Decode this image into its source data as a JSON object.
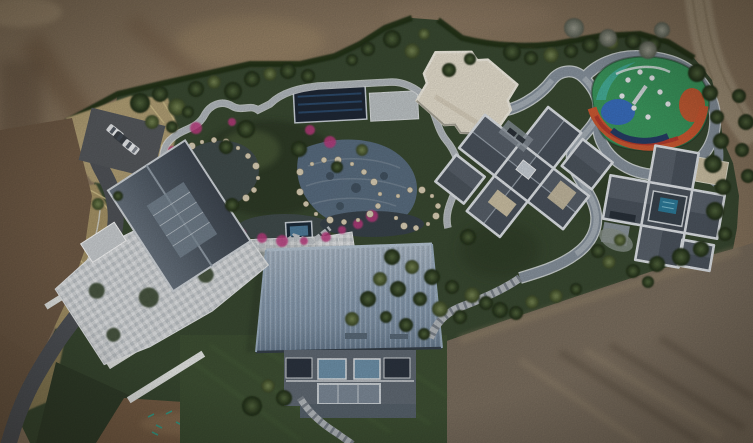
{
  "scene": {
    "type": "aerial-drone-photo",
    "description": "Top-down aerial view of a landscaped private estate surrounded by bare construction dirt: a pond garden with winding stone paths, a large blue metal-roof residence, a checkered-patio house, two gray cross-shaped villas, a cream sports court, a colorful playground, a curving asphalt driveway and a small parking area with cars.",
    "trees": [
      [
        140,
        103,
        10,
        "d"
      ],
      [
        160,
        94,
        8,
        "d"
      ],
      [
        177,
        107,
        9,
        "m"
      ],
      [
        196,
        89,
        8,
        "d"
      ],
      [
        214,
        82,
        7,
        "m"
      ],
      [
        233,
        91,
        9,
        "d"
      ],
      [
        252,
        79,
        8,
        "d"
      ],
      [
        270,
        74,
        7,
        "m"
      ],
      [
        288,
        71,
        8,
        "d"
      ],
      [
        308,
        76,
        7,
        "d"
      ],
      [
        152,
        122,
        7,
        "m"
      ],
      [
        172,
        127,
        6,
        "d"
      ],
      [
        188,
        112,
        6,
        "d"
      ],
      [
        352,
        60,
        6,
        "d"
      ],
      [
        368,
        49,
        7,
        "d"
      ],
      [
        392,
        39,
        9,
        "d"
      ],
      [
        412,
        51,
        8,
        "m"
      ],
      [
        424,
        34,
        6,
        "m"
      ],
      [
        449,
        70,
        7,
        "d"
      ],
      [
        470,
        59,
        6,
        "d"
      ],
      [
        512,
        52,
        9,
        "d"
      ],
      [
        531,
        58,
        7,
        "d"
      ],
      [
        551,
        55,
        8,
        "m"
      ],
      [
        571,
        51,
        7,
        "d"
      ],
      [
        590,
        45,
        8,
        "d"
      ],
      [
        612,
        43,
        7,
        "m"
      ],
      [
        633,
        41,
        8,
        "d"
      ],
      [
        654,
        44,
        7,
        "d"
      ],
      [
        574,
        28,
        10,
        "g"
      ],
      [
        608,
        38,
        9,
        "g"
      ],
      [
        648,
        50,
        9,
        "g"
      ],
      [
        662,
        30,
        8,
        "g"
      ],
      [
        697,
        73,
        9,
        "d"
      ],
      [
        710,
        93,
        8,
        "d"
      ],
      [
        717,
        117,
        7,
        "d"
      ],
      [
        721,
        141,
        8,
        "d"
      ],
      [
        713,
        164,
        9,
        "d"
      ],
      [
        723,
        187,
        8,
        "d"
      ],
      [
        715,
        211,
        9,
        "d"
      ],
      [
        725,
        234,
        7,
        "d"
      ],
      [
        701,
        249,
        8,
        "d"
      ],
      [
        681,
        257,
        9,
        "d"
      ],
      [
        657,
        264,
        8,
        "d"
      ],
      [
        633,
        271,
        7,
        "d"
      ],
      [
        609,
        262,
        7,
        "m"
      ],
      [
        739,
        96,
        7,
        "d"
      ],
      [
        746,
        122,
        8,
        "d"
      ],
      [
        742,
        150,
        7,
        "d"
      ],
      [
        748,
        176,
        7,
        "d"
      ],
      [
        246,
        129,
        9,
        "d"
      ],
      [
        226,
        147,
        7,
        "d"
      ],
      [
        299,
        149,
        8,
        "d"
      ],
      [
        337,
        167,
        6,
        "d"
      ],
      [
        362,
        150,
        6,
        "m"
      ],
      [
        380,
        279,
        7,
        "m"
      ],
      [
        392,
        257,
        8,
        "d"
      ],
      [
        398,
        289,
        8,
        "d"
      ],
      [
        412,
        267,
        7,
        "m"
      ],
      [
        420,
        299,
        7,
        "d"
      ],
      [
        432,
        277,
        8,
        "d"
      ],
      [
        440,
        309,
        8,
        "m"
      ],
      [
        452,
        287,
        7,
        "d"
      ],
      [
        460,
        317,
        7,
        "d"
      ],
      [
        472,
        295,
        8,
        "m"
      ],
      [
        486,
        303,
        7,
        "d"
      ],
      [
        500,
        310,
        8,
        "d"
      ],
      [
        516,
        313,
        7,
        "d"
      ],
      [
        532,
        302,
        7,
        "m"
      ],
      [
        368,
        299,
        8,
        "d"
      ],
      [
        352,
        319,
        7,
        "m"
      ],
      [
        386,
        317,
        6,
        "d"
      ],
      [
        406,
        325,
        7,
        "d"
      ],
      [
        424,
        334,
        6,
        "d"
      ],
      [
        468,
        237,
        8,
        "d"
      ],
      [
        598,
        251,
        7,
        "d"
      ],
      [
        620,
        240,
        6,
        "m"
      ],
      [
        648,
        282,
        6,
        "d"
      ],
      [
        576,
        289,
        6,
        "d"
      ],
      [
        556,
        296,
        7,
        "m"
      ],
      [
        252,
        406,
        10,
        "d"
      ],
      [
        284,
        398,
        8,
        "d"
      ],
      [
        268,
        386,
        7,
        "m"
      ],
      [
        232,
        205,
        7,
        "d"
      ],
      [
        98,
        204,
        6,
        "m"
      ],
      [
        118,
        196,
        5,
        "d"
      ]
    ],
    "flowers": [
      [
        172,
        150
      ],
      [
        168,
        172
      ],
      [
        176,
        196
      ],
      [
        190,
        208
      ],
      [
        206,
        216
      ],
      [
        224,
        226
      ],
      [
        242,
        233
      ],
      [
        262,
        238
      ],
      [
        282,
        241
      ],
      [
        304,
        241
      ],
      [
        326,
        237
      ],
      [
        196,
        128
      ],
      [
        342,
        230
      ],
      [
        358,
        224
      ],
      [
        372,
        216
      ],
      [
        232,
        122
      ],
      [
        310,
        130
      ],
      [
        330,
        142
      ]
    ],
    "rocks": [
      [
        178,
        160
      ],
      [
        184,
        152
      ],
      [
        192,
        146
      ],
      [
        202,
        142
      ],
      [
        214,
        140
      ],
      [
        226,
        142
      ],
      [
        238,
        148
      ],
      [
        248,
        156
      ],
      [
        256,
        166
      ],
      [
        258,
        178
      ],
      [
        254,
        190
      ],
      [
        246,
        198
      ],
      [
        236,
        204
      ],
      [
        224,
        208
      ],
      [
        300,
        172
      ],
      [
        312,
        164
      ],
      [
        324,
        160
      ],
      [
        338,
        160
      ],
      [
        352,
        164
      ],
      [
        364,
        172
      ],
      [
        374,
        182
      ],
      [
        380,
        194
      ],
      [
        378,
        206
      ],
      [
        370,
        214
      ],
      [
        358,
        220
      ],
      [
        344,
        222
      ],
      [
        330,
        220
      ],
      [
        316,
        214
      ],
      [
        306,
        204
      ],
      [
        300,
        192
      ],
      [
        398,
        196
      ],
      [
        410,
        190
      ],
      [
        422,
        190
      ],
      [
        432,
        196
      ],
      [
        438,
        206
      ],
      [
        436,
        216
      ],
      [
        428,
        224
      ],
      [
        416,
        228
      ],
      [
        404,
        226
      ],
      [
        396,
        218
      ]
    ],
    "equipment_dots": [
      [
        640,
        72
      ],
      [
        652,
        78
      ],
      [
        628,
        80
      ],
      [
        660,
        92
      ],
      [
        668,
        104
      ],
      [
        622,
        96
      ],
      [
        634,
        108
      ],
      [
        648,
        117
      ]
    ],
    "paint_marks": [
      [
        148,
        417
      ],
      [
        156,
        425
      ],
      [
        166,
        414
      ],
      [
        176,
        422
      ],
      [
        196,
        426
      ],
      [
        152,
        432
      ]
    ],
    "cars": [
      {
        "x": 115,
        "y": 132,
        "rot": 38,
        "color": "white"
      },
      {
        "x": 122,
        "y": 139,
        "rot": 38,
        "color": "dark"
      },
      {
        "x": 131,
        "y": 147,
        "rot": 38,
        "color": "white"
      }
    ]
  },
  "colors": {
    "dirt_base": "#8a7760",
    "dirt_left": "#715c47",
    "dirt_bottom_right": "#7d7060",
    "dirt_band": "#7b6148",
    "dirt_wedge": "#6f5a45",
    "dirt_road": "#a3937a",
    "asphalt": "#515459",
    "parking": "#56595d",
    "wheat": "#b3a176",
    "wheat_dark": "#a89568",
    "estate_green": "#3a4a32",
    "hedge": "#243019",
    "lawn": "#3f5134",
    "grass_dark": "#323f2b",
    "pond": "#424d4d",
    "pond_dark": "#39434b",
    "pool_tile": "#5d7187",
    "pool_cover": "#1f2836",
    "spa_water": "#4f7d9c",
    "small_pool": "#2e7d9c",
    "flower": "#bf3a80",
    "rock": "#ddd2b8",
    "path_light": "#b6bcc1",
    "walkway": "#8a95a0",
    "walkway_mid": "#a9b2ba",
    "roof_blue": "#8096ad",
    "facade": "#626b75",
    "glass": "#6f93ac",
    "roof_gray": "#59616b",
    "roof_gray_b": "#5b636d",
    "roof_dark": "#3e4650",
    "parapet": "#e2e6ea",
    "mosaic_light": "#d6d9db",
    "court_cream": "#e9e2d1",
    "play_green": "#3c9a5f",
    "play_blue": "#3a6fc0",
    "play_orange": "#cf5a33",
    "play_red": "#b43b2e",
    "play_teal": "#47b3a0",
    "play_navy": "#273d66",
    "car_white": "#e9ebed",
    "car_dark": "#3a3f45",
    "wall_white": "#e9ebe8",
    "paint_teal": "#3aa08a",
    "courtyard_tan": "#cfc3a6"
  }
}
